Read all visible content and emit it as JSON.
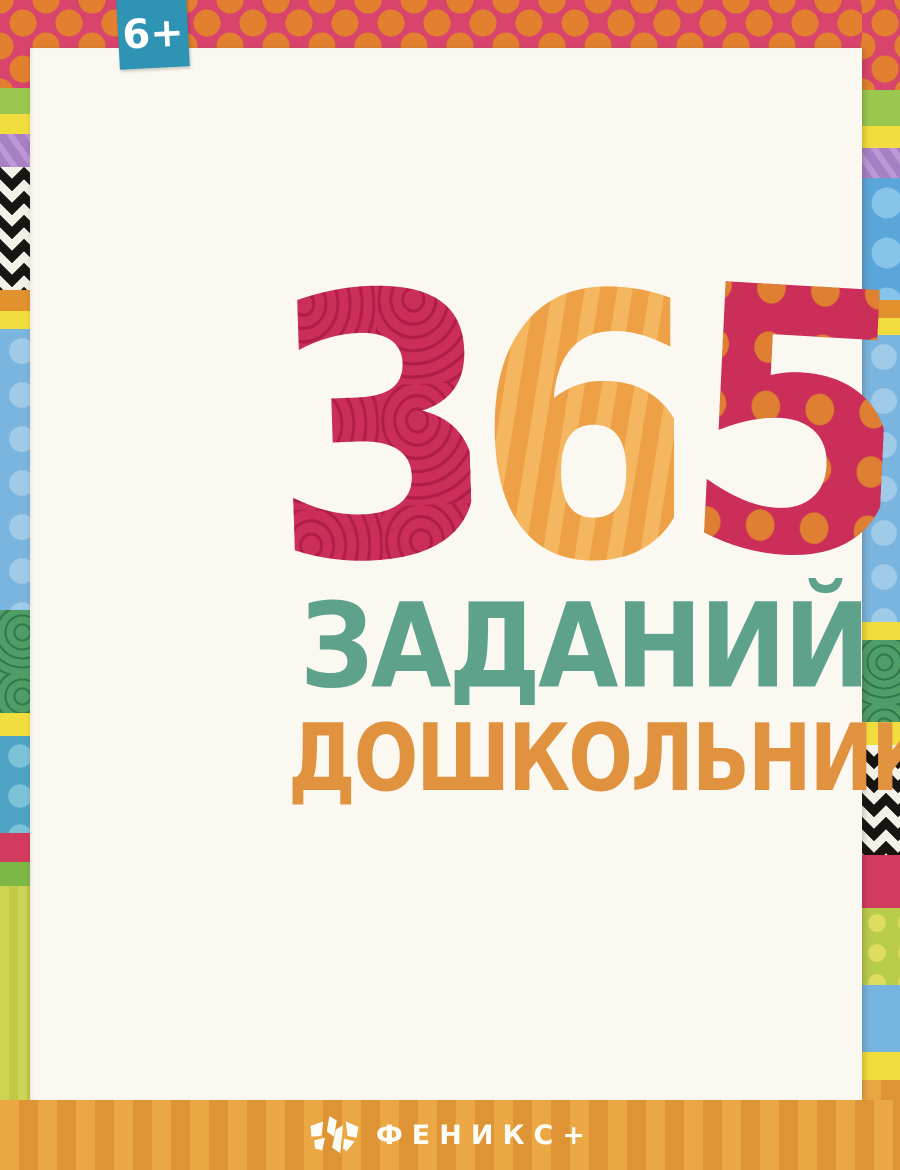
{
  "badge": {
    "label": "6+"
  },
  "title": {
    "digits": [
      "3",
      "6",
      "5"
    ],
    "word1": "ЗАДАНИЙ",
    "word2": "ДОШКОЛЬНИКА"
  },
  "fgos": {
    "line1": "Разработано",
    "line2": "с учётом",
    "acronym": "ФГОС",
    "line3": "дошкольного",
    "line4": "образования"
  },
  "topics": {
    "bullet": "•",
    "items": [
      "ПИСЬМО",
      "СЧЁТ",
      "ЛОГИКА",
      "ВНИМАНИЕ"
    ]
  },
  "girl": {
    "notebook_label": "ДНЕВНИК"
  },
  "cow": {
    "caption": "К=В В=Н"
  },
  "ready": {
    "word1": "К",
    "word2": "ШКОЛЕ",
    "word3": "ГОТОВ!"
  },
  "publisher": {
    "name": "ФЕНИКС+"
  },
  "colors": {
    "title_crimson": "#cb2e58",
    "title_orange": "#e99b3d",
    "title_teal": "#5fa28b",
    "title_word2_orange": "#e0923e",
    "badge_teal": "#2f93b4",
    "fgos_panel_yellow": "#f7e24b",
    "fgos_red": "#d5375c",
    "fgos_blue": "#3d7eb0",
    "topics_panel_orange": "#dc8a33",
    "shapes_panel_lime": "#b7c85c",
    "catmaze_panel_pink": "#d1679e",
    "girl_panel_blue": "#6fb0dc",
    "cow_panel_lavender": "#a98bc5",
    "ready_panel_crimson": "#c93158",
    "ready_yellow": "#f6d83c",
    "dots_panel_teal": "#6fa896",
    "bottom_band_orange": "#e7a13e",
    "top_band_pink": "#d8446b"
  }
}
